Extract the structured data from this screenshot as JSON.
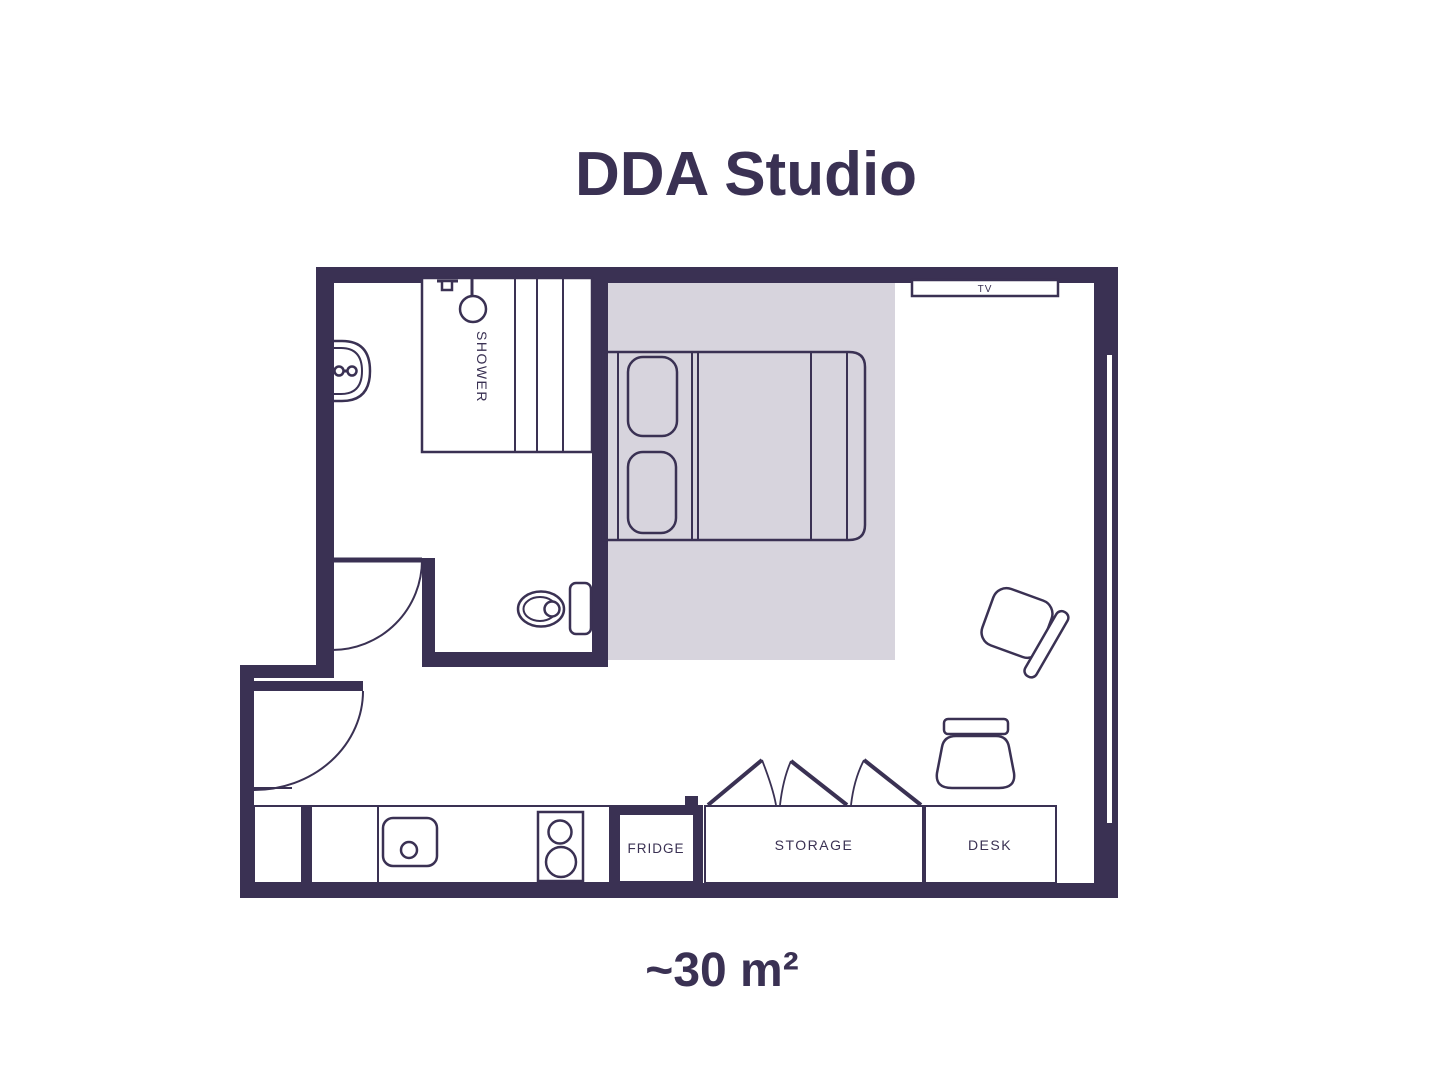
{
  "title": "DDA Studio",
  "area": "~30 m²",
  "labels": {
    "shower": "SHOWER",
    "tv": "TV",
    "fridge": "FRIDGE",
    "storage": "STORAGE",
    "desk": "DESK"
  },
  "colors": {
    "wall": "#3a3153",
    "line": "#3a3153",
    "bed_zone": "#d7d4dd",
    "background": "#ffffff",
    "text": "#3a3153"
  }
}
